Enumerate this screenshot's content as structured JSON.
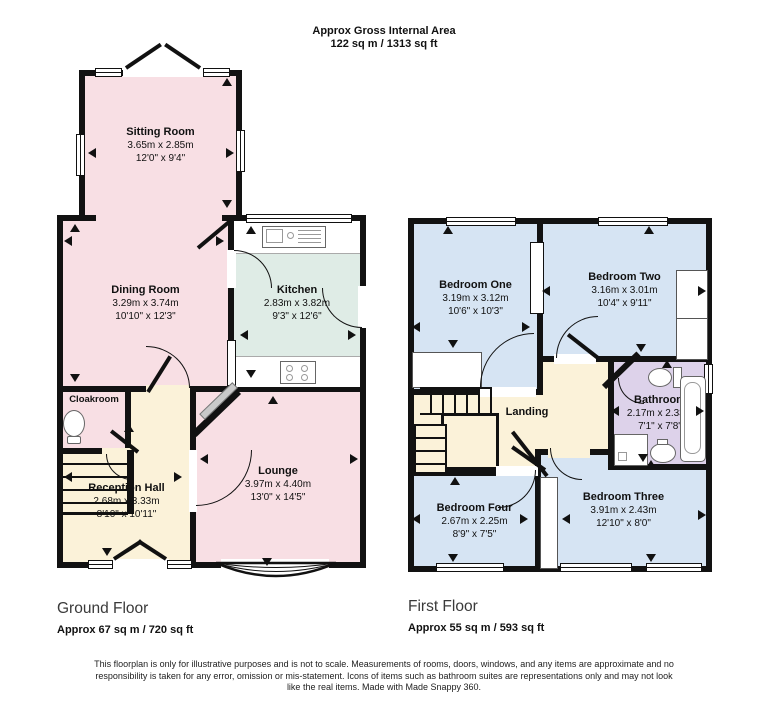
{
  "header": {
    "line1": "Approx Gross Internal Area",
    "line2": "122 sq m / 1313 sq ft"
  },
  "ground_floor": {
    "label": "Ground Floor",
    "area": "Approx 67 sq m / 720 sq ft",
    "rooms": {
      "sitting_room": {
        "name": "Sitting Room",
        "metric": "3.65m x 2.85m",
        "imperial": "12'0\" x 9'4\""
      },
      "dining_room": {
        "name": "Dining Room",
        "metric": "3.29m x 3.74m",
        "imperial": "10'10\" x 12'3\""
      },
      "kitchen": {
        "name": "Kitchen",
        "metric": "2.83m x 3.82m",
        "imperial": "9'3\" x 12'6\""
      },
      "cloakroom": {
        "name": "Cloakroom"
      },
      "reception_hall": {
        "name": "Reception Hall",
        "metric": "2.68m x 3.33m",
        "imperial": "8'10\" x 10'11\""
      },
      "lounge": {
        "name": "Lounge",
        "metric": "3.97m x 4.40m",
        "imperial": "13'0\" x 14'5\""
      }
    }
  },
  "first_floor": {
    "label": "First Floor",
    "area": "Approx 55 sq m / 593 sq ft",
    "rooms": {
      "bedroom_one": {
        "name": "Bedroom One",
        "metric": "3.19m x 3.12m",
        "imperial": "10'6\" x 10'3\""
      },
      "bedroom_two": {
        "name": "Bedroom Two",
        "metric": "3.16m x 3.01m",
        "imperial": "10'4\" x 9'11\""
      },
      "bathroom": {
        "name": "Bathroom",
        "metric": "2.17m x 2.33m",
        "imperial": "7'1\" x 7'8\""
      },
      "landing": {
        "name": "Landing"
      },
      "bedroom_four": {
        "name": "Bedroom Four",
        "metric": "2.67m x 2.25m",
        "imperial": "8'9\" x 7'5\""
      },
      "bedroom_three": {
        "name": "Bedroom Three",
        "metric": "3.91m x 2.43m",
        "imperial": "12'10\" x 8'0\""
      }
    }
  },
  "disclaimer": "This floorplan is only for illustrative purposes and is not to scale. Measurements of rooms, doors, windows, and any items are approximate and no responsibility is taken for any error, omission or mis-statement. Icons of items such as bathroom suites are representations only and may not look like the real items. Made with Made Snappy 360.",
  "colors": {
    "room_pink": "#f8dfe4",
    "room_mint": "#dfece6",
    "room_cream": "#fbf2d9",
    "room_blue": "#d6e4f3",
    "room_lavender": "#ddd2ea",
    "wall": "#121212"
  },
  "icons": {
    "dimension_arrow": "css-triangle",
    "toilet": "css-shape",
    "bathtub": "css-shape",
    "shower": "css-shape",
    "basin": "css-shape",
    "stove": "css-shape",
    "kitchen_sink": "css-shape",
    "stairs": "css-lines",
    "bay_window": "svg-arcs",
    "door_swing": "css-arc"
  }
}
